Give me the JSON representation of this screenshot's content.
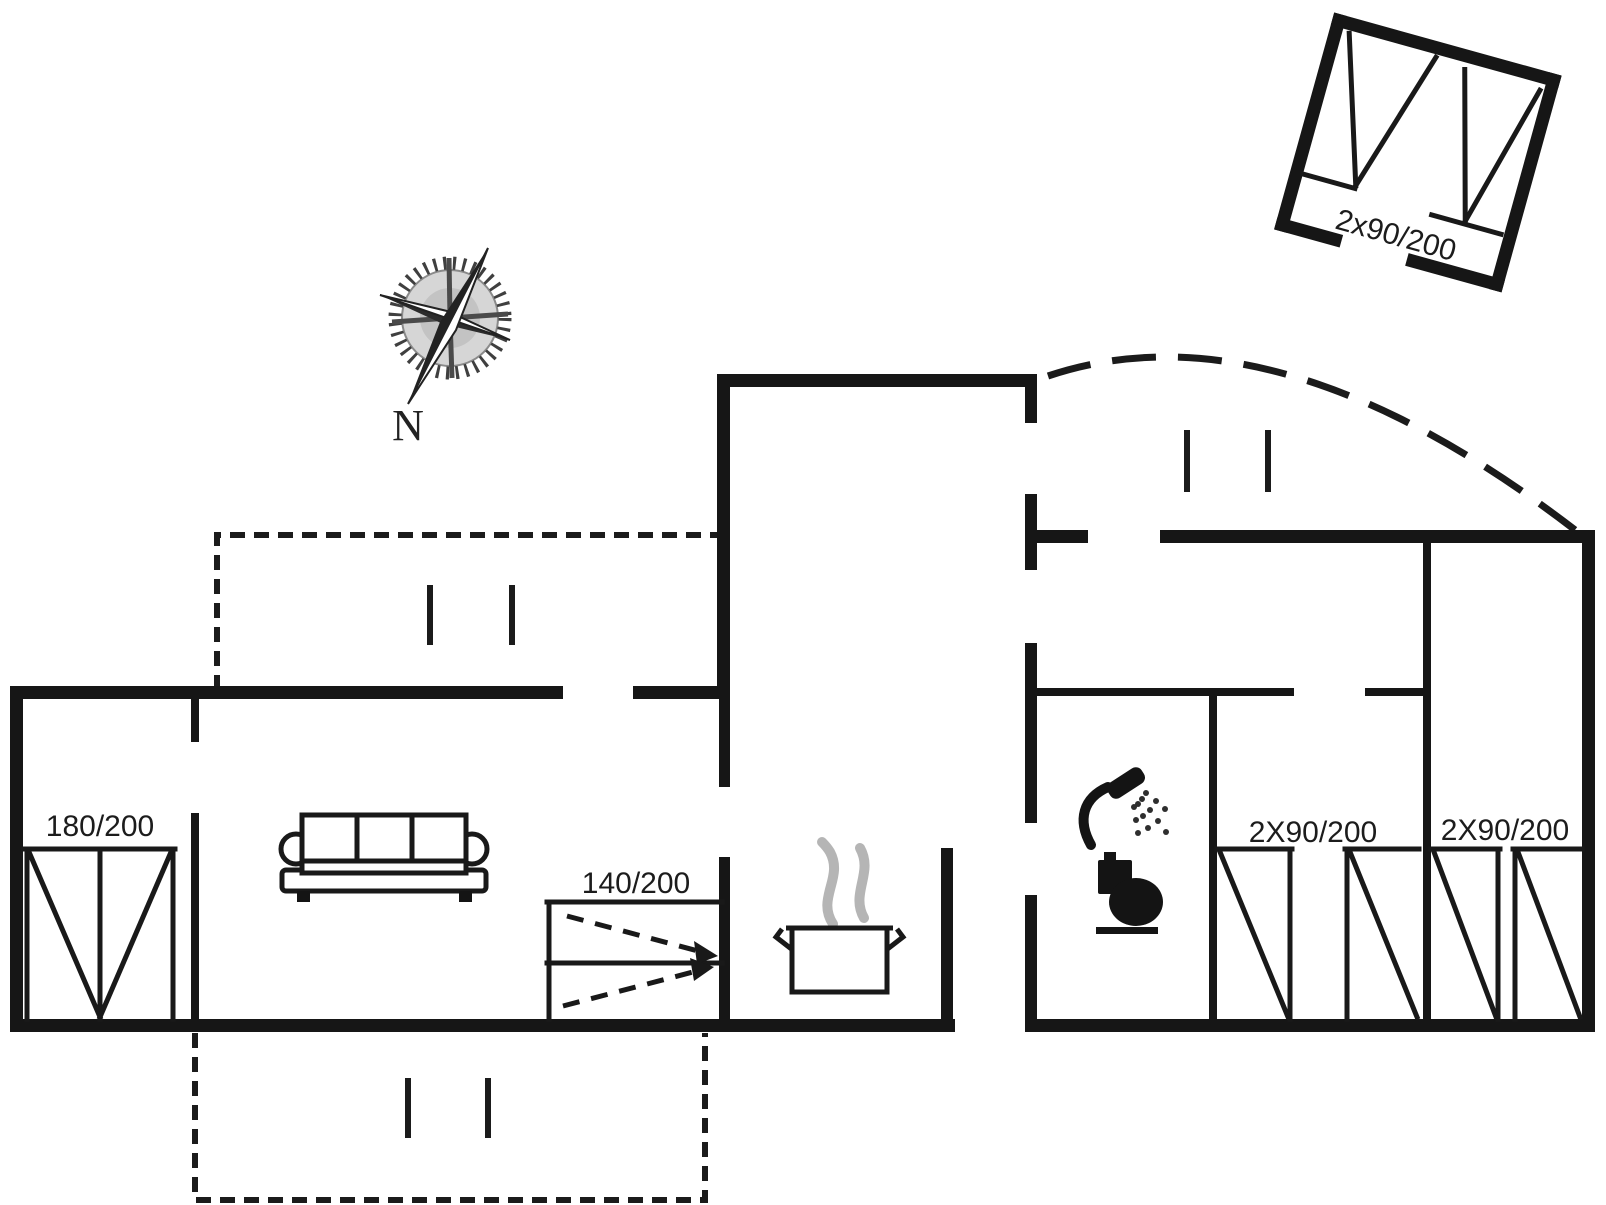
{
  "compass": {
    "north_label": "N",
    "icon": "compass-rose-icon"
  },
  "beds": {
    "master_bedroom": "180/200",
    "living_room_foldout": "140/200",
    "bedroom_one": "2X90/200",
    "bedroom_two": "2X90/200",
    "annex": "2x90/200"
  },
  "icons": {
    "compass": "compass-rose-icon",
    "sofa": "sofa-icon",
    "stove_pot": "cooking-pot-icon",
    "steam": "steam-icon",
    "shower": "shower-icon",
    "toilet": "toilet-icon",
    "double_bed": "double-bed-icon",
    "single_bed": "single-bed-icon"
  },
  "colors": {
    "line": "#161616",
    "steam_gray": "#b5b5b5",
    "background": "#ffffff"
  }
}
